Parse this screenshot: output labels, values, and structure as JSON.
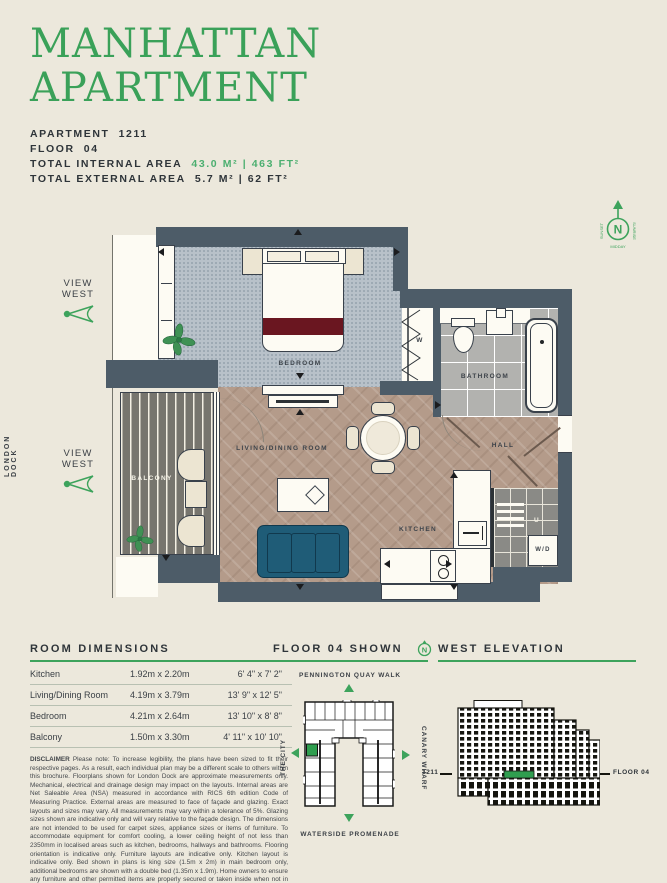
{
  "title": {
    "line1": "MANHATTAN",
    "line2": "APARTMENT"
  },
  "info": {
    "apartment_label": "APARTMENT",
    "apartment_value": "1211",
    "floor_label": "FLOOR",
    "floor_value": "04",
    "internal_label": "TOTAL INTERNAL AREA",
    "internal_value": "43.0 M² | 463 FT²",
    "external_label": "TOTAL EXTERNAL AREA",
    "external_value": "5.7 M² | 62 FT²"
  },
  "side_label": "LONDON DOCK",
  "view_west_upper": "VIEW WEST",
  "view_west_lower": "VIEW WEST",
  "compass": {
    "n": "N",
    "sunset": "SUNSET",
    "sunrise": "SUNRISE",
    "midday": "MIDDAY"
  },
  "plan": {
    "bedroom": "BEDROOM",
    "bathroom": "BATHROOM",
    "hall": "HALL",
    "living_dining": "LIVING/DINING ROOM",
    "kitchen": "KITCHEN",
    "balcony": "BALCONY",
    "wardrobe": "W",
    "utility": "U",
    "washer_dryer": "W/D"
  },
  "room_dimensions": {
    "header": "ROOM DIMENSIONS",
    "rows": [
      {
        "room": "Kitchen",
        "metric": "1.92m x 2.20m",
        "imperial": "6' 4\" x 7' 2\""
      },
      {
        "room": "Living/Dining Room",
        "metric": "4.19m x 3.79m",
        "imperial": "13' 9\" x 12' 5\""
      },
      {
        "room": "Bedroom",
        "metric": "4.21m x 2.64m",
        "imperial": "13' 10\" x 8' 8\""
      },
      {
        "room": "Balcony",
        "metric": "1.50m x 3.30m",
        "imperial": "4' 11\" x 10' 10\""
      }
    ]
  },
  "disclaimer": {
    "label": "DISCLAIMER",
    "text": " Please note: To increase legibility, the plans have been sized to fit their respective pages. As a result, each individual plan may be a different scale to others within this brochure. Floorplans shown for London Dock are approximate measurements only. Mechanical, electrical and drainage design may impact on the layouts. Internal areas are Net Saleable Area (NSA) measured in accordance with RICS 6th edition Code of Measuring Practice. External areas are measured to face of façade and glazing. Exact layouts and sizes may vary. All measurements may vary within a tolerance of 5%. Glazing sizes shown are indicative only and will vary relative to the façade design. The dimensions are not intended to be used for carpet sizes, appliance sizes or items of furniture. To accommodate equipment for comfort cooling, a lower ceiling height of not less than 2350mm in localised areas such as kitchen, bedrooms, hallways and bathrooms. Flooring orientation is indicative only. Furniture layouts are indicative only. Kitchen layout is indicative only. Bed shown in plans is king size (1.5m x 2m) in main bedroom only, additional bedrooms are shown with a double bed (1.35m x 1.9m). Home owners to ensure any furniture and other permitted items are properly secured or taken inside when not in use to prevent them from being blown from balconies or terraces causing serious damage and injury below. Colours are indicative only and may vary depending on customer palette selection. Views are indicative only. Please ask Sales Consultant for further information."
  },
  "floorplate": {
    "header": "FLOOR 04 SHOWN",
    "compass_n": "N",
    "street_top": "PENNINGTON QUAY WALK",
    "street_left": "THE CITY",
    "street_right": "CANARY WHARF",
    "street_bottom": "WATERSIDE PROMENADE"
  },
  "elevation": {
    "header": "WEST ELEVATION",
    "unit_label": "1211",
    "floor_label": "FLOOR 04"
  },
  "colors": {
    "accent_green": "#3da35c",
    "value_green": "#4caf70",
    "wall": "#4d5c68",
    "wood_floor": "#b49b8a",
    "carpet": "#b8c1c9",
    "deck": "#77756e",
    "sofa": "#1f5c77",
    "bed_throw": "#6a1620",
    "highlight_unit": "#2f9e4f"
  }
}
